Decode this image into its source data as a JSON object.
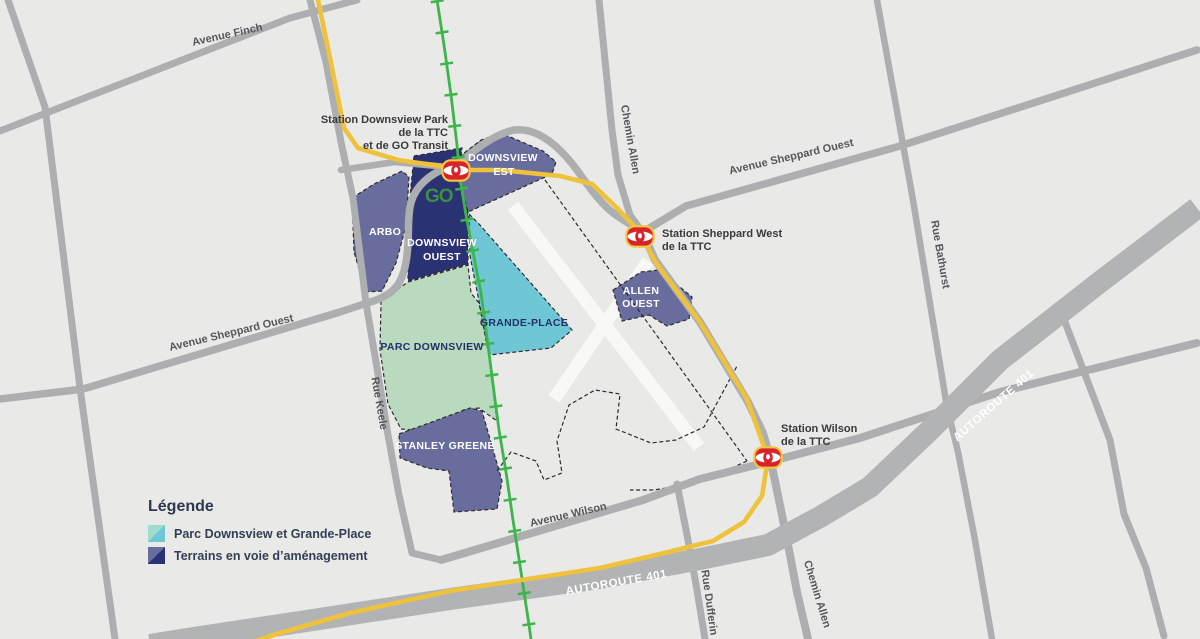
{
  "title": "Carte du secteur Downsview",
  "colors": {
    "background": "#e9e9e7",
    "road_gray": "#acaeb0",
    "highway_gray": "#b1b3b5",
    "subway_yellow": "#efc23c",
    "rail_green": "#3cb54a",
    "area_purple": "#696d9e",
    "area_navy": "#2b3274",
    "area_lightgreen": "#b9dabf",
    "area_teal": "#6fc7d6",
    "runway_white": "#f8f8f7",
    "ttc_red": "#d8232a",
    "go_green": "#3c8f43"
  },
  "roads": {
    "finch": "Avenue Finch",
    "sheppard_ouest_west": "Avenue Sheppard Ouest",
    "sheppard_ouest_east": "Avenue Sheppard Ouest",
    "allen_north": "Chemin Allen",
    "allen_south": "Chemin Allen",
    "bathurst": "Rue Bathurst",
    "keele": "Rue Keele",
    "wilson": "Avenue Wilson",
    "dufferin": "Rue Dufferin",
    "autoroute_401_upper": "AUTOROUTE 401",
    "autoroute_401_lower": "AUTOROUTE 401"
  },
  "stations": {
    "downsview_park": {
      "lines": [
        "Station Downsview Park",
        "de la TTC",
        "et de GO Transit"
      ]
    },
    "sheppard_west": {
      "lines": [
        "Station Sheppard West",
        "de la TTC"
      ]
    },
    "wilson": {
      "lines": [
        "Station Wilson",
        "de la TTC"
      ]
    }
  },
  "areas": {
    "arbo": "ARBO",
    "downsview_ouest": {
      "lines": [
        "DOWNSVIEW",
        "OUEST"
      ]
    },
    "downsview_est": {
      "lines": [
        "DOWNSVIEW",
        "EST"
      ]
    },
    "allen_ouest": {
      "lines": [
        "ALLEN",
        "OUEST"
      ]
    },
    "parc_downsview": "PARC DOWNSVIEW",
    "grande_place": "GRANDE-PLACE",
    "stanley_greene": "STANLEY GREENE"
  },
  "legend": {
    "title": "Légende",
    "items": [
      {
        "label": "Parc Downsview et Grande-Place",
        "colors": [
          "#9fdccc",
          "#6fc7d6"
        ]
      },
      {
        "label": "Terrains en voie d’aménagement",
        "colors": [
          "#696d9e",
          "#2b3274"
        ]
      }
    ]
  },
  "icons": {
    "ttc_logo": "ttc-logo",
    "go_logo_text": "GO"
  }
}
